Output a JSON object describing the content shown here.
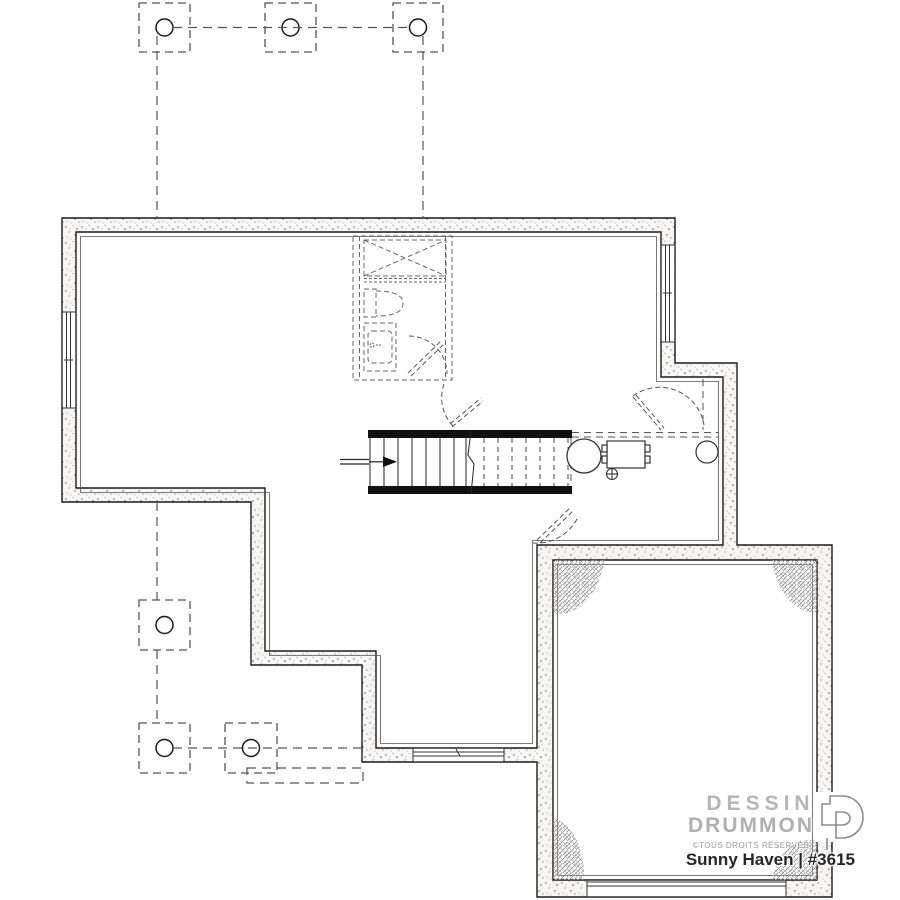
{
  "branding": {
    "line1": "DESSINS",
    "line2": "DRUMMOND",
    "copyright": "©TOUS DROITS RÉSERVÉS",
    "logo_icon": "drummond-d-logo"
  },
  "plan": {
    "title": "Sunny Haven | #3615",
    "type": "basement floor plan"
  },
  "colors": {
    "line": "#1a1a1a",
    "dashed_line": "#555555",
    "wall_fill": "#f6f5f3",
    "hatch": "#8f8f8f",
    "brand_gray": "#b3b3b3",
    "title_text": "#262626",
    "stair_bar": "#111111"
  },
  "symbols": [
    "porch-column-footing-top-1",
    "porch-column-footing-top-2",
    "porch-column-footing-top-3",
    "deck-column-footing-left",
    "deck-column-footing-bottom-1",
    "deck-column-footing-bottom-2",
    "future-bathroom-rough-in",
    "tub-shower",
    "toilet",
    "sink-vanity",
    "staircase",
    "stair-direction-arrow",
    "stair-break-line",
    "water-heater",
    "furnace-unit",
    "floor-drain",
    "sump-pit",
    "door-swing-bathroom",
    "door-swing-hall",
    "door-swing-right-wall",
    "door-swing-garage-entry",
    "window-left-wall",
    "window-right-wall",
    "window-bottom-wall",
    "garage-overhead-door",
    "earth-backfill-hatch-corners",
    "concrete-wall-stipple",
    "deck-outline-dashed"
  ]
}
